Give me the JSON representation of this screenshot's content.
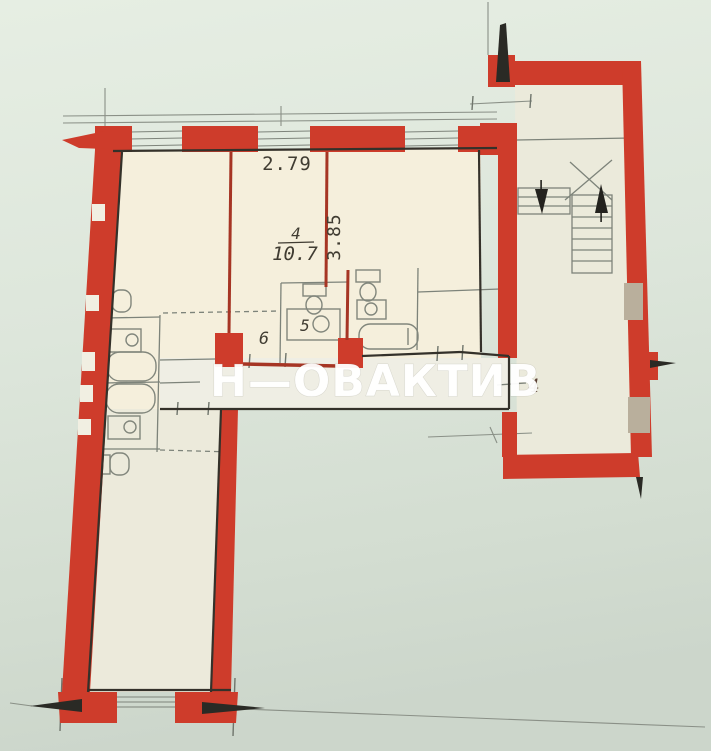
{
  "watermark": {
    "text": "Н—ОВАКТИВ"
  },
  "plan": {
    "room_4": {
      "number": "4",
      "area": "10.7",
      "width_m": "2.79",
      "depth_m": "3.85"
    },
    "room_5_label": "5",
    "room_6_label": "6",
    "hall_label": "4"
  },
  "colors": {
    "background_paper": "#dde6db",
    "wall_red": "#ce3c2b",
    "partition_red": "#a63524",
    "room_fill": "#f5efdc",
    "corridor_fill": "#efeee4",
    "stairwell_fill": "#ebeadb",
    "line_dark": "#2f2d27",
    "line_gray": "#7d837a",
    "stair_window_tan": "#b9af9c",
    "watermark_white": "#ffffff"
  }
}
